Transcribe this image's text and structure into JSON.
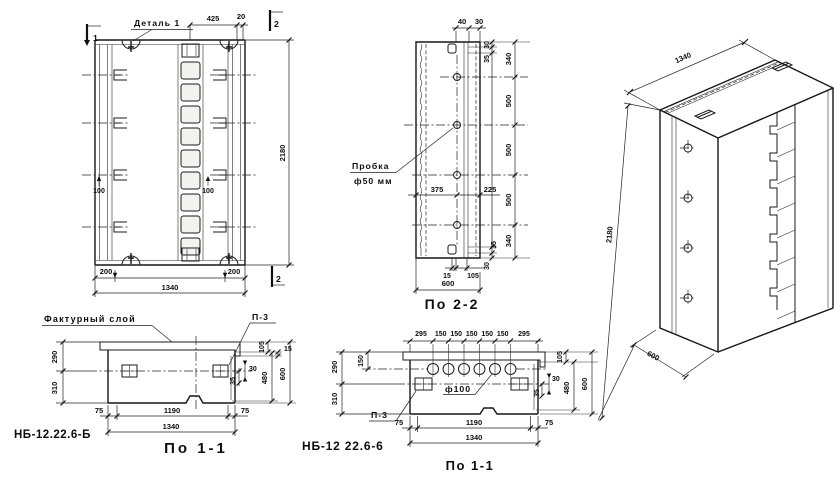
{
  "front_view": {
    "detail_label": "Деталь 1",
    "section_mark_top_left": "1",
    "section_mark_top_right": "2",
    "section_mark_bottom_right": "2",
    "dim_top_425": "425",
    "dim_top_20": "20",
    "dim_clamp_left": "100",
    "dim_clamp_right": "100",
    "dim_height": "2180",
    "dim_bottom_left_200": "200",
    "dim_bottom_right_200": "200",
    "dim_width": "1340"
  },
  "section_2_2": {
    "caption": "По 2-2",
    "dim_top_40": "40",
    "dim_top_30": "30",
    "dim_right_30_top": "30",
    "dim_right_35_top": "35",
    "dim_right_340_top": "340",
    "dim_right_500_1": "500",
    "dim_right_500_2": "500",
    "dim_right_500_3": "500",
    "dim_right_340_bottom": "340",
    "dim_right_35_bottom": "35",
    "dim_right_30_bottom": "30",
    "plug_label_line1": "Пробка",
    "plug_label_line2": "ф50 мм",
    "dim_375": "375",
    "dim_225": "225",
    "dim_bottom_15": "15",
    "dim_bottom_105": "105",
    "dim_width": "600"
  },
  "section_1_1_left": {
    "caption": "По 1-1",
    "designation": "НБ-12.22.6-Б",
    "facade_label": "Фактурный слой",
    "plate_label": "П-3",
    "dim_290": "290",
    "dim_310": "310",
    "dim_105": "105",
    "dim_15": "15",
    "dim_30": "30",
    "dim_35": "35",
    "dim_480": "480",
    "dim_600": "600",
    "dim_75_left": "75",
    "dim_1190": "1190",
    "dim_75_right": "75",
    "dim_1340": "1340"
  },
  "section_1_1_mid": {
    "caption": "По 1-1",
    "designation": "НБ-12 22.6-6",
    "plate_label": "П-3",
    "hole_label": "ф100",
    "dims_top": [
      "295",
      "150",
      "150",
      "150",
      "150",
      "150",
      "295"
    ],
    "dim_290": "290",
    "dim_150": "150",
    "dim_310": "310",
    "dim_105": "105",
    "dim_30": "30",
    "dim_35": "35",
    "dim_480": "480",
    "dim_600": "600",
    "dim_75_left": "75",
    "dim_1190": "1190",
    "dim_75_right": "75",
    "dim_1340": "1340"
  },
  "isometric": {
    "dim_width": "1340",
    "dim_height": "2180",
    "dim_depth": "600"
  }
}
